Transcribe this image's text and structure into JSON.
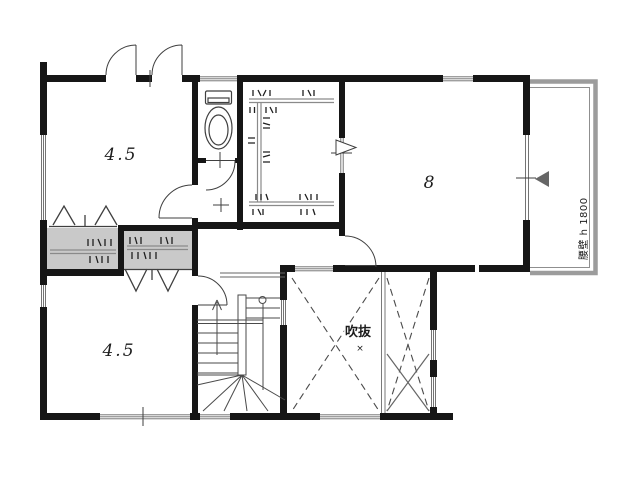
{
  "plan": {
    "rooms": {
      "bedroom_top_left": {
        "label": "4.5"
      },
      "bedroom_bottom_left": {
        "label": "4.5"
      },
      "bedroom_right": {
        "label": "8"
      },
      "void_space": {
        "label": "吹抜",
        "center_mark": "×"
      },
      "balcony": {
        "label": "腰壁 h 1800"
      }
    }
  },
  "colors": {
    "wall": "#161616",
    "closet_fill": "#c9c9c9",
    "pipe": "#8a8a8a",
    "balcony_outline": "#9c9c9c",
    "balcony_inner": "#8f8f8f",
    "thin_line": "#3f3f3f",
    "stair_line": "#4a4a4a",
    "dashed_line": "#4a4a4a",
    "window_line": "#666666",
    "hanger": "#1f1f1f",
    "divider": "#7a7a7a",
    "triangle_fill": "#666666",
    "text": "#1c1c1c"
  }
}
